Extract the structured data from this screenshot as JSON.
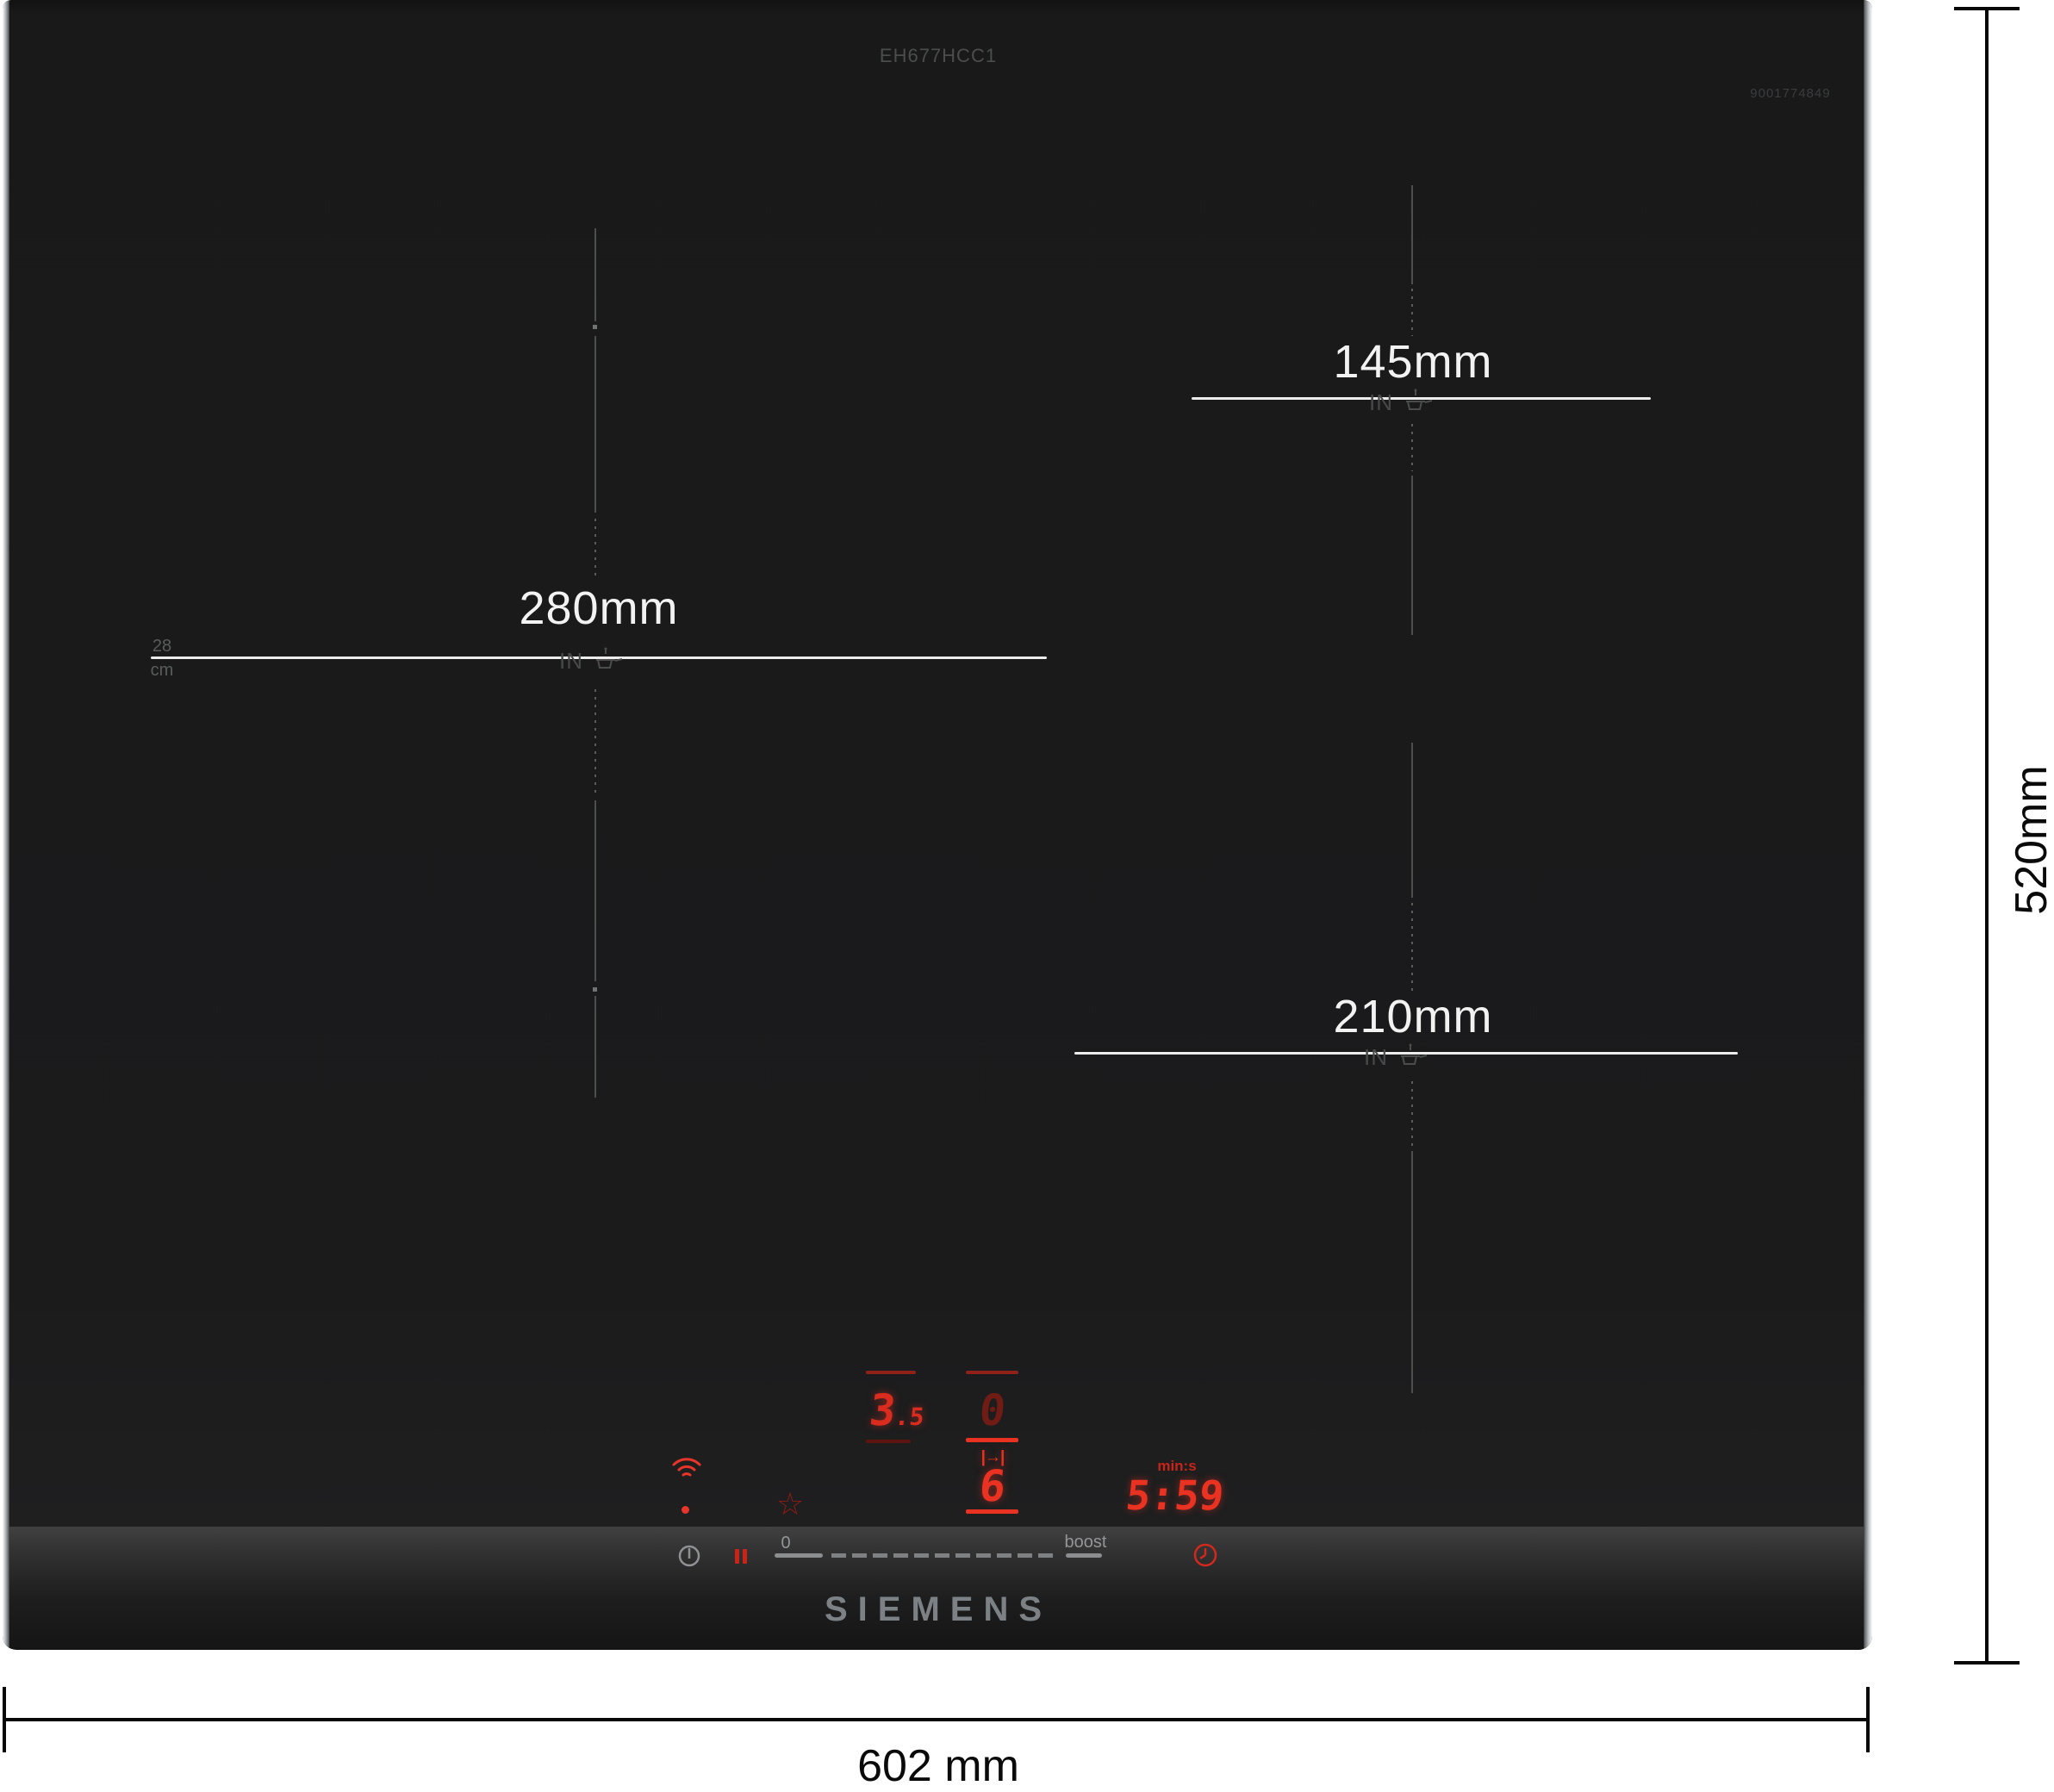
{
  "product": {
    "model_number": "EH677HCC1",
    "reference_number": "9001774849",
    "brand": "SIEMENS"
  },
  "overall_dimensions": {
    "width_label": "602 mm",
    "depth_label": "520mm"
  },
  "cooking_zones": {
    "left": {
      "diameter_label": "280mm",
      "size_top": "28",
      "size_bottom": "cm",
      "induction_label": "IN"
    },
    "top_right": {
      "diameter_label": "145mm",
      "induction_label": "IN"
    },
    "bottom_right": {
      "diameter_label": "210mm",
      "induction_label": "IN"
    }
  },
  "control_panel": {
    "left_zone_display": {
      "power_level_main": "3",
      "power_level_sub": ".5"
    },
    "right_zone_display": {
      "upper_value": "0",
      "move_glyph": "|→|",
      "lower_value": "6"
    },
    "timer_display": {
      "unit_label": "min:s",
      "value": "5:59"
    },
    "slider": {
      "min_label": "0",
      "boost_label": "boost"
    },
    "favorite_glyph": "☆"
  },
  "colors": {
    "bright_red": "#ea3222",
    "dim_red": "#701b14",
    "bar_red": "#8e221b",
    "panel_gray": "#939596",
    "logo_gray": "#7c8185"
  }
}
